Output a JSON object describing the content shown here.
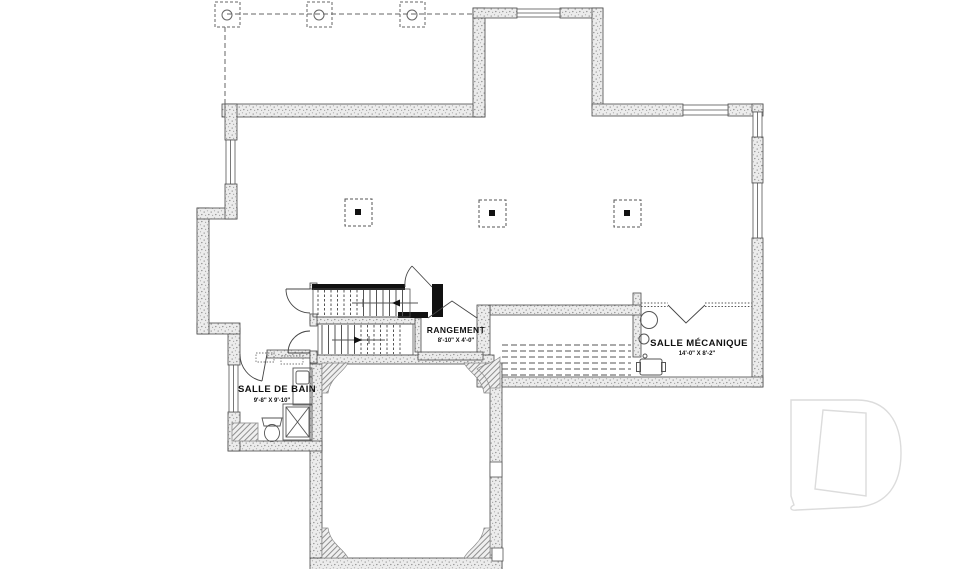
{
  "plan": {
    "title": "basement-floor-plan",
    "rooms": {
      "bathroom": {
        "label": "SALLE DE BAIN",
        "size": "9'-8\" X 9'-10\""
      },
      "storage": {
        "label": "RANGEMENT",
        "size": "8'-10\" X 4'-0\""
      },
      "mechanical": {
        "label": "SALLE MÉCANIQUE",
        "size": "14'-0\" X 8'-2\""
      }
    },
    "colors": {
      "wall_line": "#4a4a4a",
      "wall_fill": "#ececec",
      "black_wall": "#111111",
      "thin_line": "#555555",
      "logo": "#dcdcdc",
      "background": "#ffffff"
    }
  }
}
